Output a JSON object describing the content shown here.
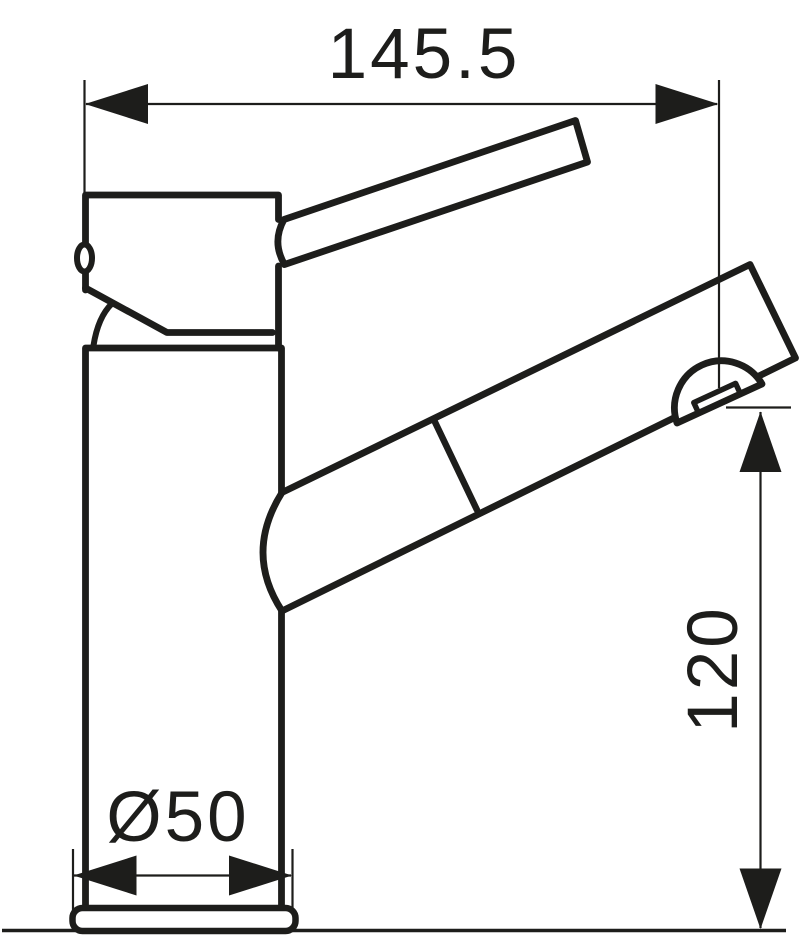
{
  "colors": {
    "line": "#1d1d1b",
    "background": "#ffffff"
  },
  "dims": {
    "width": {
      "label": "145.5",
      "value": 145.5
    },
    "height": {
      "label": "120",
      "value": 120
    },
    "base_diameter": {
      "label": "Ø50",
      "value": 50
    }
  }
}
